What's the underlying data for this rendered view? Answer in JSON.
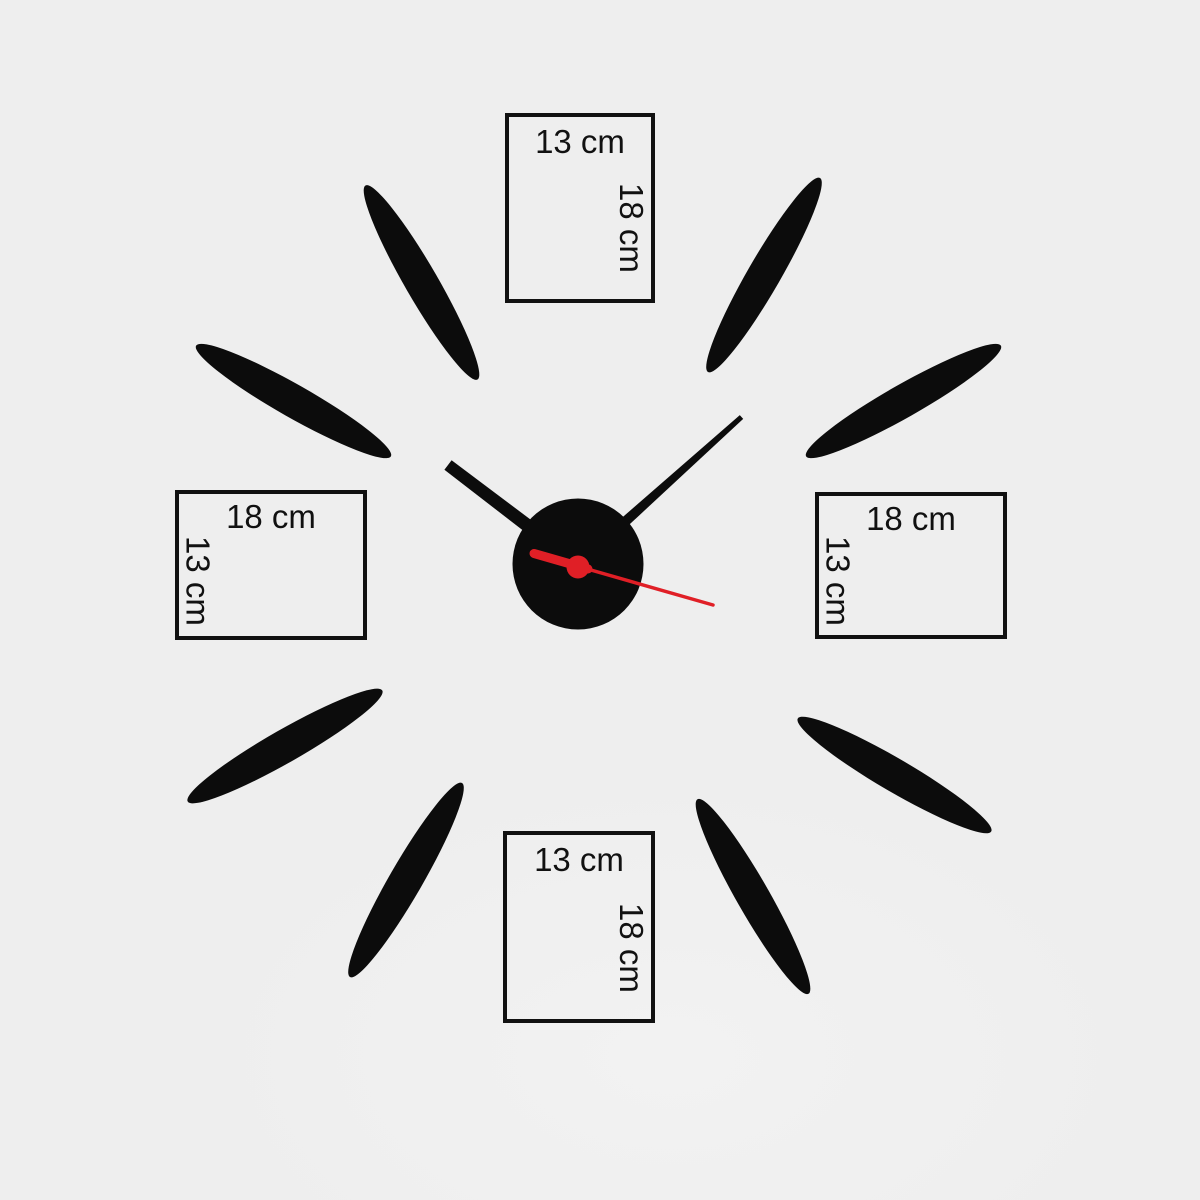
{
  "colors": {
    "background": "#eeeeee",
    "sticker": "#0c0c0c",
    "second_hand": "#e01f26",
    "box_border": "#111111",
    "label_text": "#111111"
  },
  "boxes": {
    "top": {
      "width_label": "13 cm",
      "height_label": "18 cm"
    },
    "bottom": {
      "width_label": "13 cm",
      "height_label": "18 cm"
    },
    "left": {
      "width_label": "18 cm",
      "height_label": "13 cm"
    },
    "right": {
      "width_label": "18 cm",
      "height_label": "13 cm"
    }
  }
}
